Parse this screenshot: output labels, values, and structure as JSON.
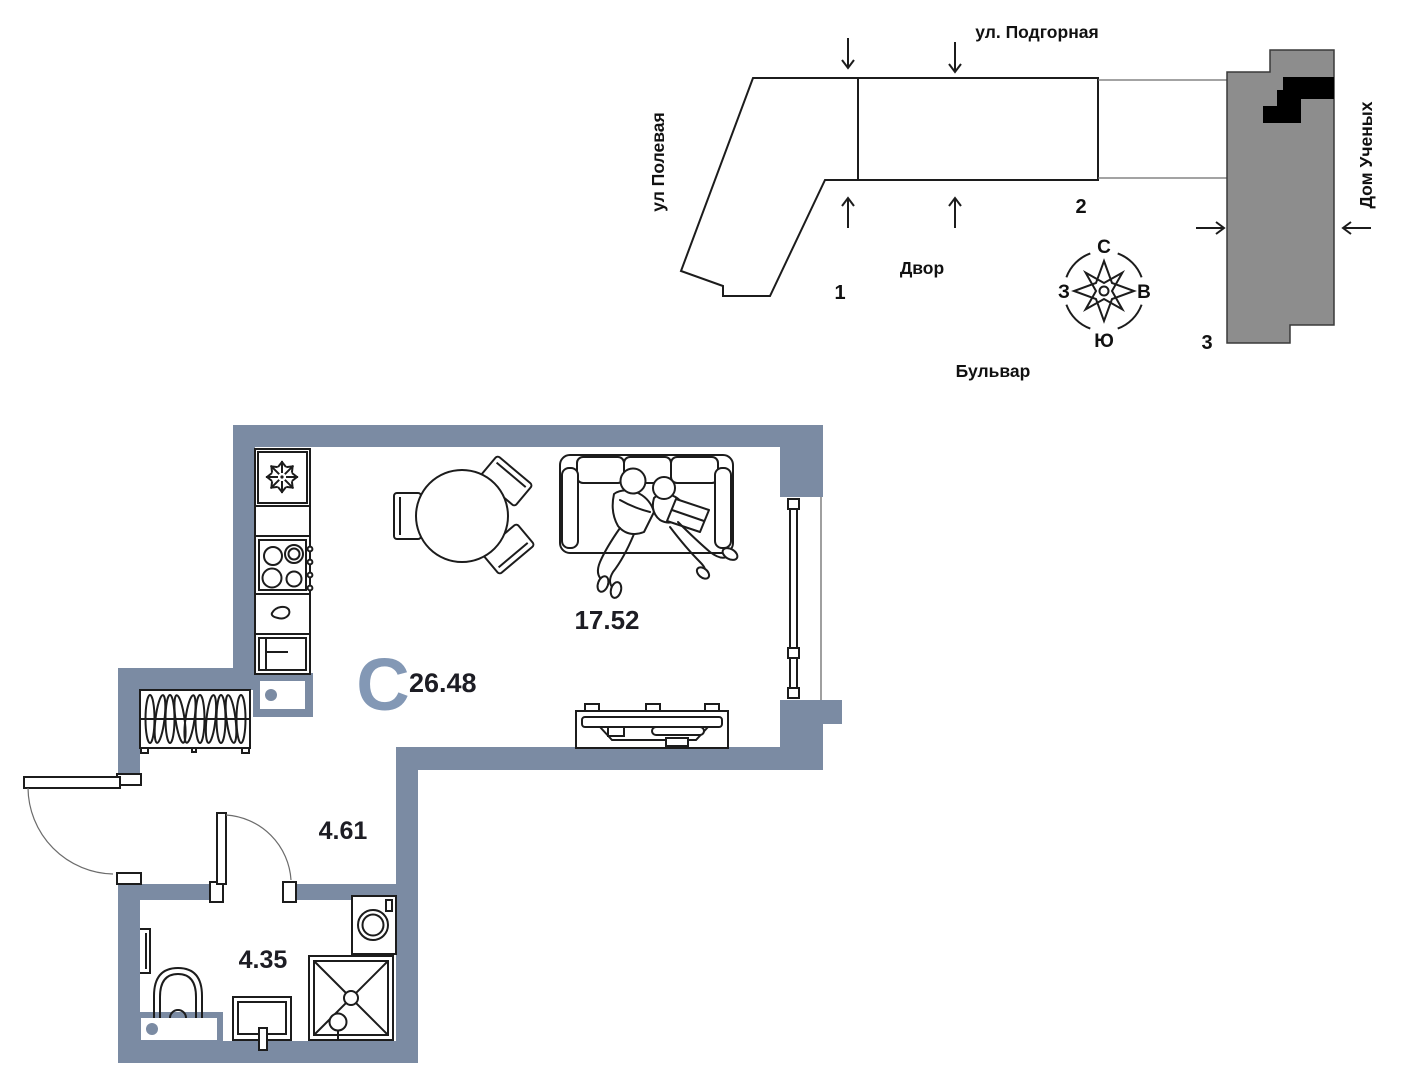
{
  "site_plan": {
    "street_top": "ул. Подгорная",
    "street_left": "ул Полевая",
    "street_right": "Дом Ученых",
    "yard_label": "Двор",
    "boulevard_label": "Бульвар",
    "building_1": "1",
    "building_2": "2",
    "building_3": "3",
    "compass": {
      "n": "С",
      "s": "Ю",
      "w": "З",
      "e": "В"
    }
  },
  "floor_plan": {
    "type_letter": "С",
    "total_area": "26.48",
    "living_area": "17.52",
    "hall_area": "4.61",
    "bath_area": "4.35"
  },
  "colors": {
    "wall": "#7b8ba3",
    "accent_letter": "#8398b5",
    "building_fill": "#8d8d8d",
    "apartment_marker": "#000000",
    "line": "#1c1c1c"
  }
}
